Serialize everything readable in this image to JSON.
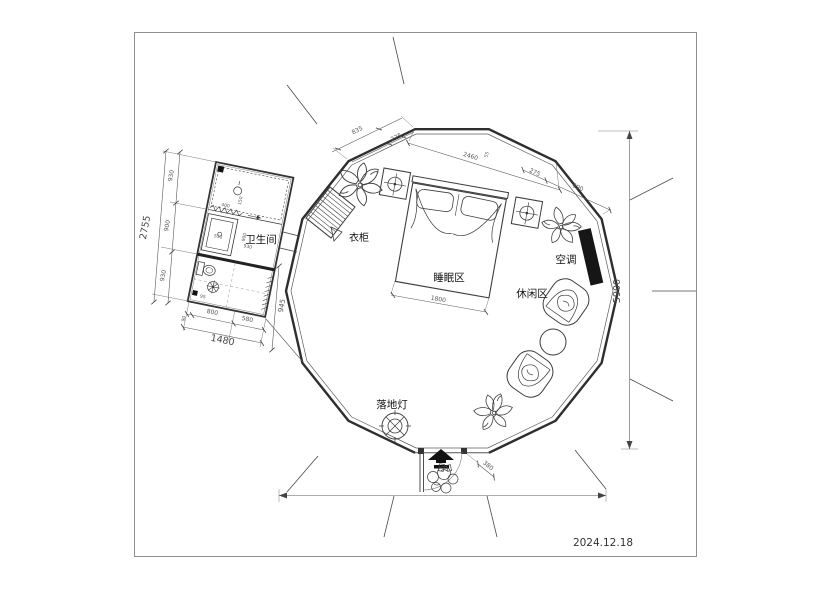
{
  "page": {
    "date": "2024.12.18"
  },
  "labels": {
    "bathroom": "卫生间",
    "wardrobe": "衣柜",
    "sleeping_area": "睡眠区",
    "air_conditioner": "空调",
    "leisure_area": "休闲区",
    "floor_lamp": "落地灯"
  },
  "dimensions": {
    "left_total": "2755",
    "left_chain": [
      "930",
      "900",
      "930"
    ],
    "bathroom_bottom_chain": [
      "800",
      "580"
    ],
    "bathroom_bottom_small": "90",
    "bathroom_bottom_total": "1480",
    "bathroom_right": "945",
    "bathroom_inner": {
      "counter_width": "400",
      "counter_depth": "150",
      "shower_width": "550",
      "mid_width": "900",
      "mid_depth": "930",
      "corner": "95"
    },
    "top_chain": [
      "835",
      "275",
      "2460",
      "55",
      "275",
      "690"
    ],
    "bed_width": "1800",
    "overall_height": "5900",
    "entry_offset": "380"
  }
}
